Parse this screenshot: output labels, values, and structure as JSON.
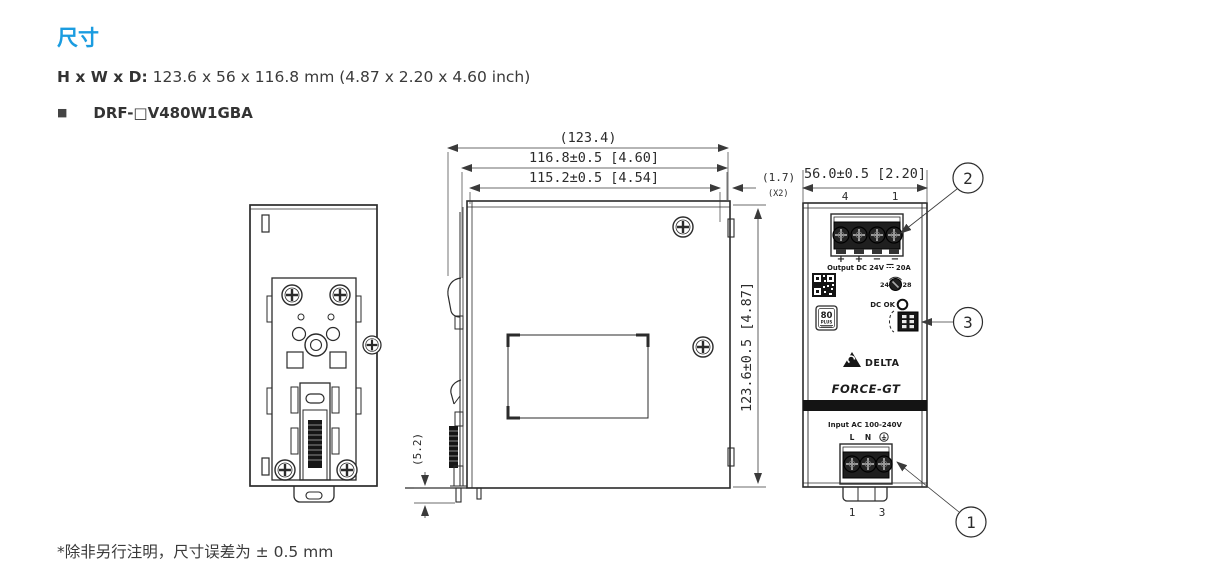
{
  "page": {
    "title": "尺寸",
    "dimensions_label": "H x W x D:",
    "dimensions_value": " 123.6 x 56 x 116.8 mm (4.87 x 2.20 x 4.60 inch)",
    "bullet": "■",
    "model": "DRF-□V480W1GBA",
    "footnote": "*除非另行注明，尺寸误差为 ± 0.5 mm"
  },
  "colors": {
    "accent": "#1b9ce0",
    "line": "#2b2b2b",
    "text": "#333333"
  },
  "drawing": {
    "side_view": {
      "dim_overall_depth": "(123.4)",
      "dim_depth": "116.8±0.5  [4.60]",
      "dim_body_depth": "115.2±0.5  [4.54]",
      "dim_offset": "(1.7)",
      "dim_offset_qty": "(X2)",
      "dim_height": "123.6±0.5  [4.87]",
      "dim_clip": "(5.2)"
    },
    "front_view": {
      "dim_width": "56.0±0.5  [2.20]",
      "terminal_top_left": "4",
      "terminal_top_right": "1",
      "polarity": [
        "+",
        "+",
        "−",
        "−"
      ],
      "output_label_left": "Output DC 24V",
      "output_label_right": "20A",
      "adjust_min": "24",
      "adjust_max": "28",
      "dc_ok_label": "DC OK",
      "badge_80plus": "80",
      "badge_80plus_sub": "PLUS",
      "brand": "DELTA",
      "series": "FORCE-GT",
      "input_label": "Input AC 100-240V",
      "line_label": "L",
      "neutral_label": "N",
      "ground_icon": "earth-ground",
      "terminal_bottom_left": "1",
      "terminal_bottom_right": "3"
    },
    "callouts": {
      "input_terminal": "1",
      "output_terminal": "2",
      "signal_connector": "3"
    }
  }
}
